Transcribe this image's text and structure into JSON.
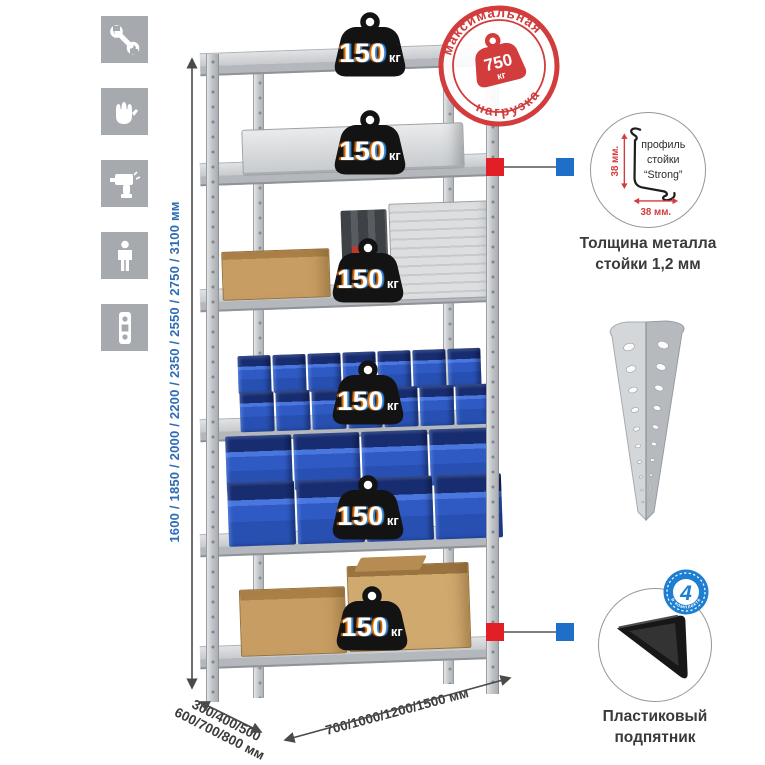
{
  "icons": {
    "tile_color": "#a6aaae",
    "items": [
      "wrench",
      "gloves",
      "drill",
      "person",
      "power-strip"
    ]
  },
  "height_dimension": {
    "text": "1600 / 1850 / 2000 / 2200 / 2350 / 2550 / 2750 / 3100 мм",
    "color": "#2e6cb4"
  },
  "depth_dimension": {
    "line1": "300/400/500",
    "line2": "600/700/800 мм"
  },
  "width_dimension": {
    "text": "700/1000/1200/1500 мм"
  },
  "rack": {
    "shelf_count": 6,
    "loads": [
      {
        "value": "150",
        "unit": "кг"
      },
      {
        "value": "150",
        "unit": "кг"
      },
      {
        "value": "150",
        "unit": "кг"
      },
      {
        "value": "150",
        "unit": "кг"
      },
      {
        "value": "150",
        "unit": "кг"
      },
      {
        "value": "150",
        "unit": "кг"
      }
    ]
  },
  "max_load_stamp": {
    "arc_top": "максимальная",
    "arc_bottom": "нагрузка",
    "value": "750",
    "unit": "кг",
    "color": "#d23c3c"
  },
  "callout_colors": {
    "post_marker": "#e21f26",
    "detail_marker": "#1d6fc8"
  },
  "profile_detail": {
    "label_line1": "профиль",
    "label_line2": "стойки",
    "label_line3": "“Strong”",
    "vertical_dim": "38 мм.",
    "horizontal_dim": "38 мм.",
    "caption_line1": "Толщина металла",
    "caption_line2": "стойки 1,2 мм"
  },
  "foot_detail": {
    "badge_value": "4",
    "badge_arc": "в комплекте",
    "caption_line1": "Пластиковый",
    "caption_line2": "подпятник"
  }
}
